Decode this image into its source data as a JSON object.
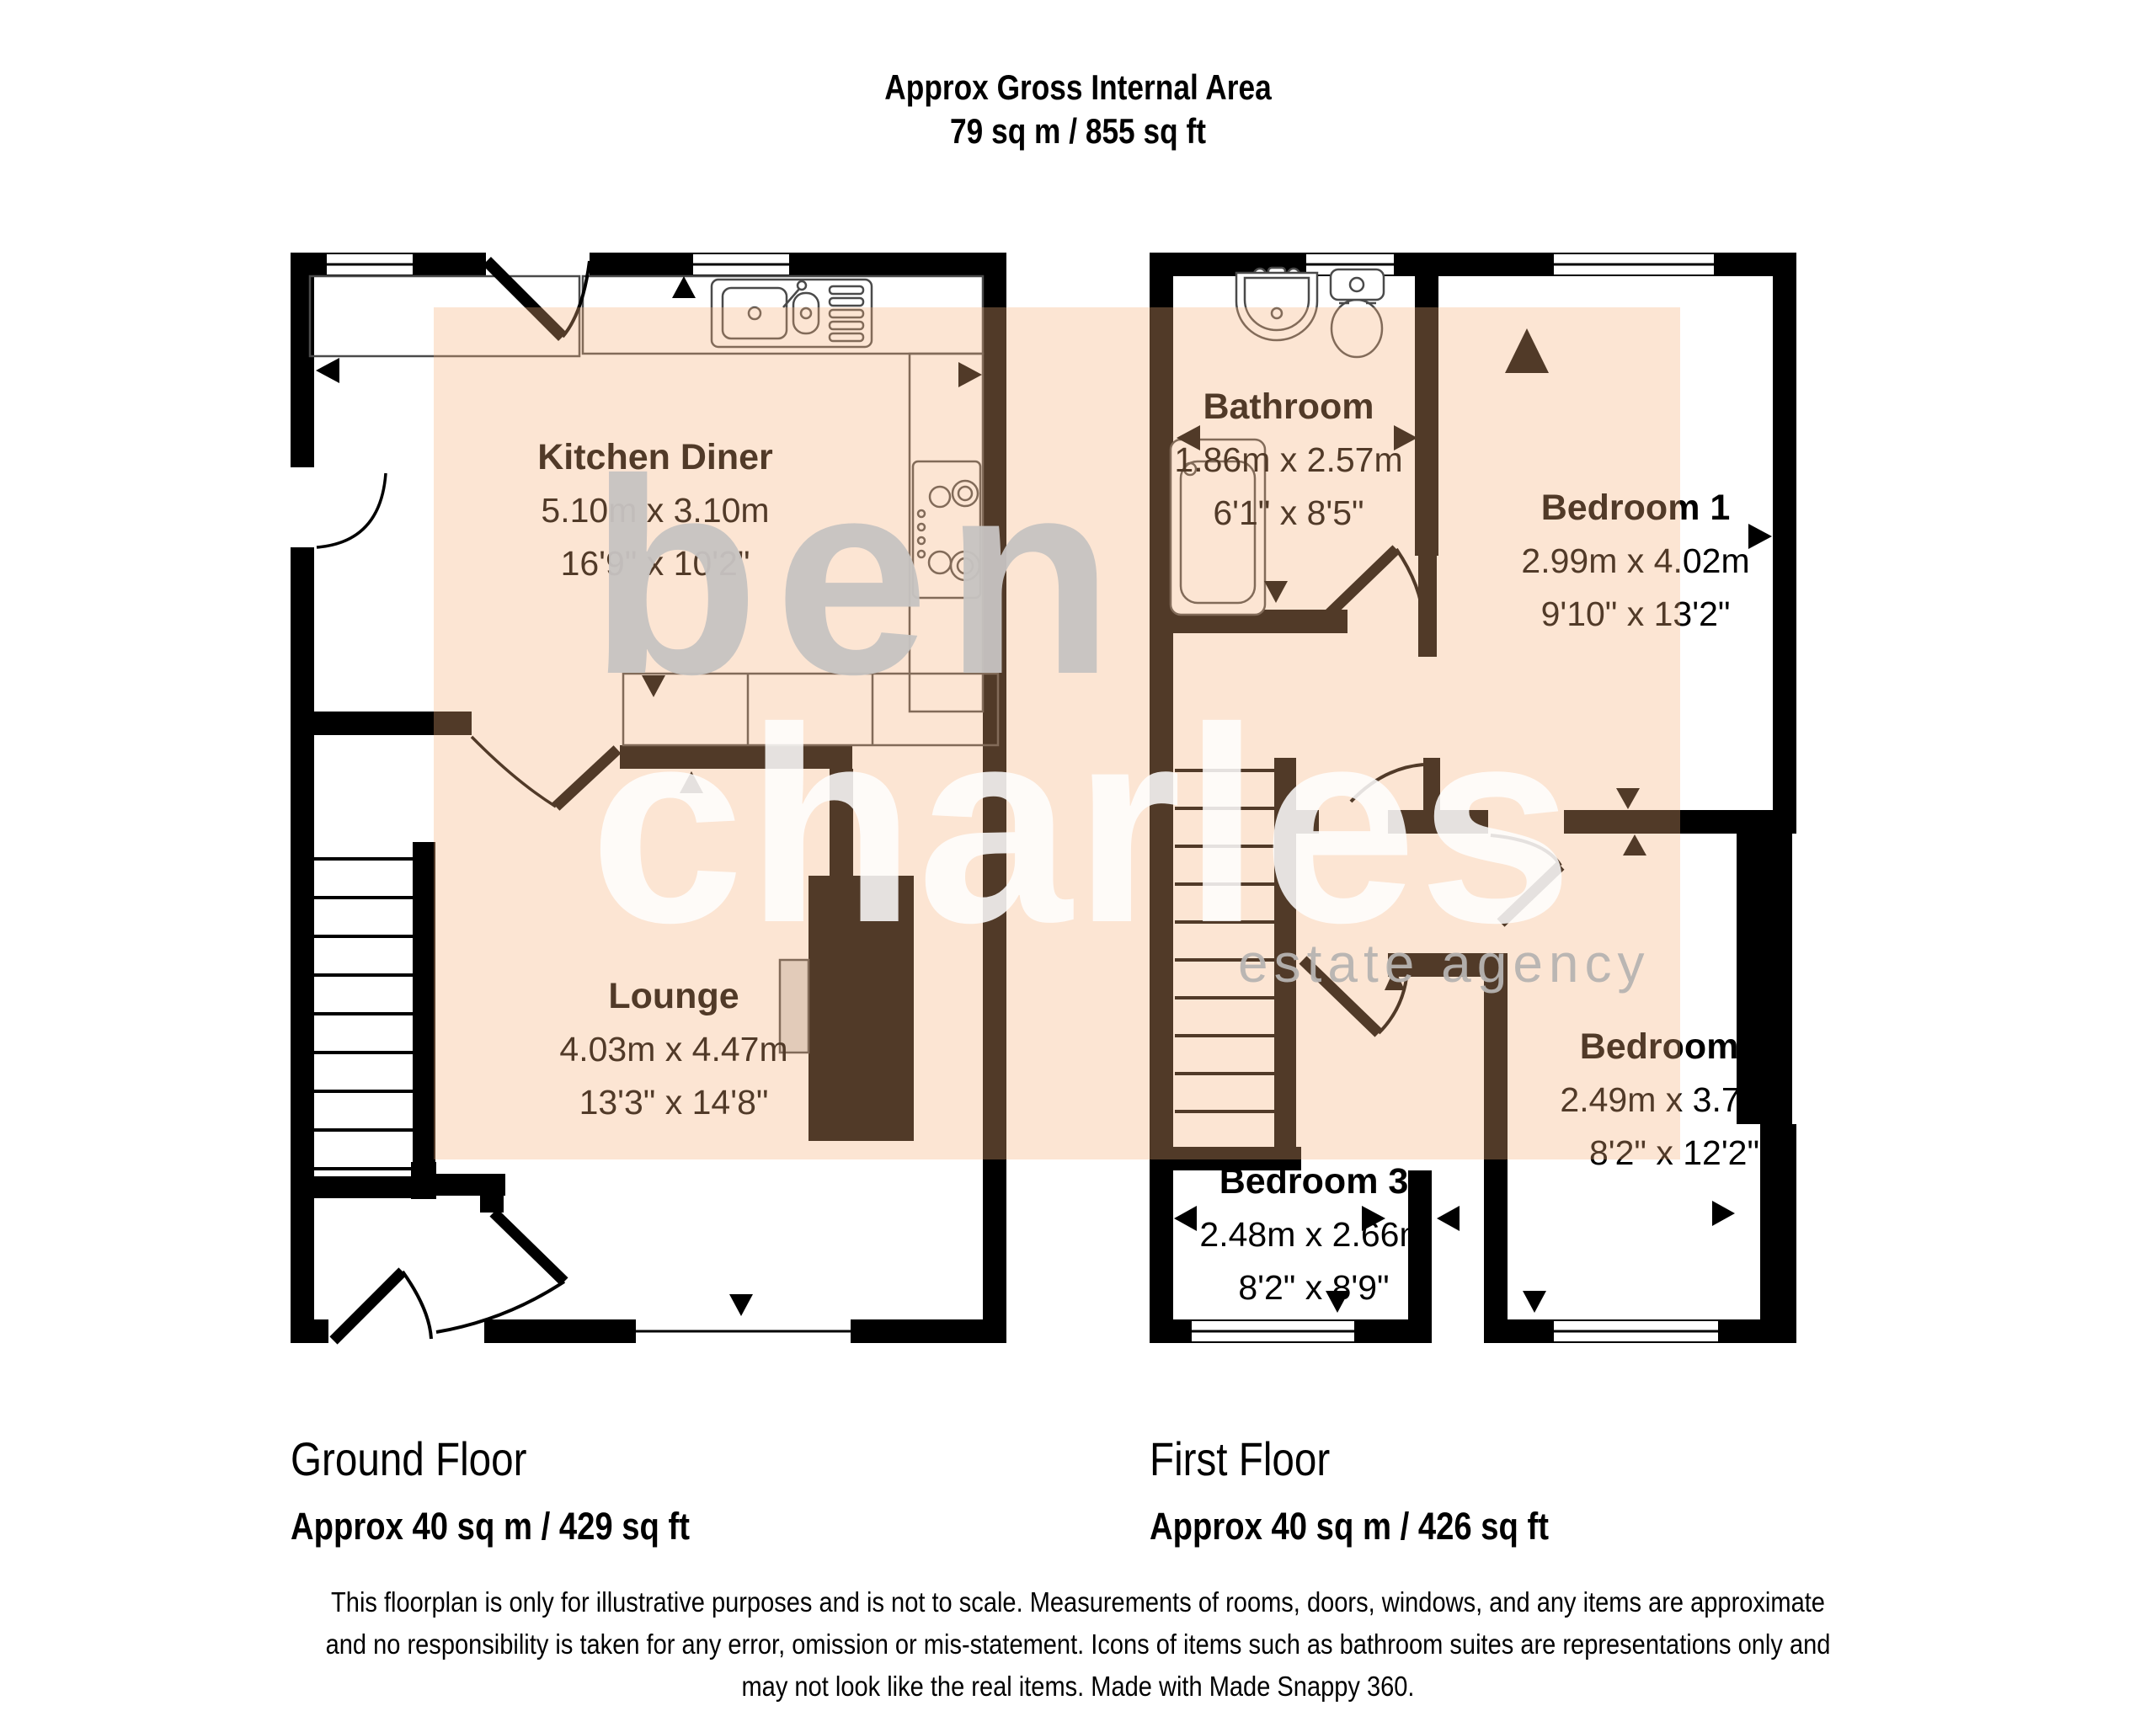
{
  "header": {
    "line1": "Approx Gross Internal Area",
    "line2": "79 sq m / 855 sq ft"
  },
  "watermark": {
    "word1": "ben",
    "word2": "charles",
    "tagline": "estate agency"
  },
  "rooms": [
    {
      "name": "Kitchen Diner",
      "metric": "5.10m x 3.10m",
      "imperial": "16'9\" x 10'2\""
    },
    {
      "name": "Lounge",
      "metric": "4.03m x 4.47m",
      "imperial": "13'3\" x 14'8\""
    },
    {
      "name": "Bathroom",
      "metric": "1.86m x 2.57m",
      "imperial": "6'1\" x 8'5\""
    },
    {
      "name": "Bedroom 1",
      "metric": "2.99m x 4.02m",
      "imperial": "9'10\" x 13'2\""
    },
    {
      "name": "Bedroom 2",
      "metric": "2.49m x 3.70m",
      "imperial": "8'2\" x 12'2\""
    },
    {
      "name": "Bedroom 3",
      "metric": "2.48m x 2.66m",
      "imperial": "8'2\" x 8'9\""
    }
  ],
  "floors": [
    {
      "name": "Ground Floor",
      "area": "Approx 40 sq m / 429 sq ft"
    },
    {
      "name": "First Floor",
      "area": "Approx 40 sq m / 426 sq ft"
    }
  ],
  "disclaimer": {
    "line1": "This floorplan is only for illustrative purposes and is not to scale. Measurements of rooms, doors, windows, and any items are approximate",
    "line2": "and no responsibility is taken for any error, omission or mis-statement. Icons of items such as bathroom suites are representations only and",
    "line3": "may not look like the real items. Made with Made Snappy 360."
  },
  "colors": {
    "highlight": "#F6B17A",
    "wall": "#000000",
    "watermark_gray": "#C7C4C2",
    "watermark_white": "#FFFFFF"
  }
}
